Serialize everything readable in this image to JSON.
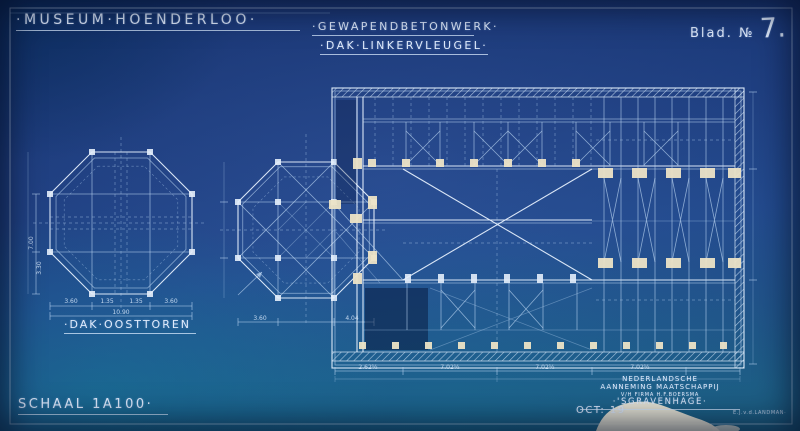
{
  "header": {
    "project_title": "·MUSEUM·HOENDERLOO·",
    "drawing_type": "·GEWAPENDBETONWERK·",
    "drawing_part": "·DAK·LINKERVLEUGEL·",
    "sheet_label": "Blad. №",
    "sheet_number": "7."
  },
  "labels": {
    "left_drawing": "·DAK·OOSTTOREN",
    "scale": "SCHAAL 1A100·"
  },
  "title_block": {
    "company_line1": "NEDERLANDSCHE",
    "company_line2": "AANNEMING MAATSCHAPPIJ",
    "company_line3": "V/H FIRMA H.F.BOERSMA",
    "company_line4": "·'SGRAVENHAGE·",
    "date": "OCT: 19",
    "signature": "E.J.v.d.LANDMAN·"
  },
  "dimensions": {
    "oct_seg1": "3.60",
    "oct_seg2": "1.35",
    "oct_seg3": "1.35",
    "oct_seg4": "3.60",
    "oct_total": "10.90",
    "oct_left1": "7.00",
    "oct_left2": "3.30",
    "mid_seg1": "3.60",
    "mid_seg2": "4.04",
    "plan_bay1": "2.62½",
    "plan_bay2": "7.02½",
    "plan_bay3": "7.02½",
    "plan_bay4": "7.02½"
  },
  "colors": {
    "paper_blue": "#1e4080",
    "line_white": "#d9e9fb",
    "column_cream": "#ece3c6",
    "stain_cream": "#efe9d8"
  }
}
